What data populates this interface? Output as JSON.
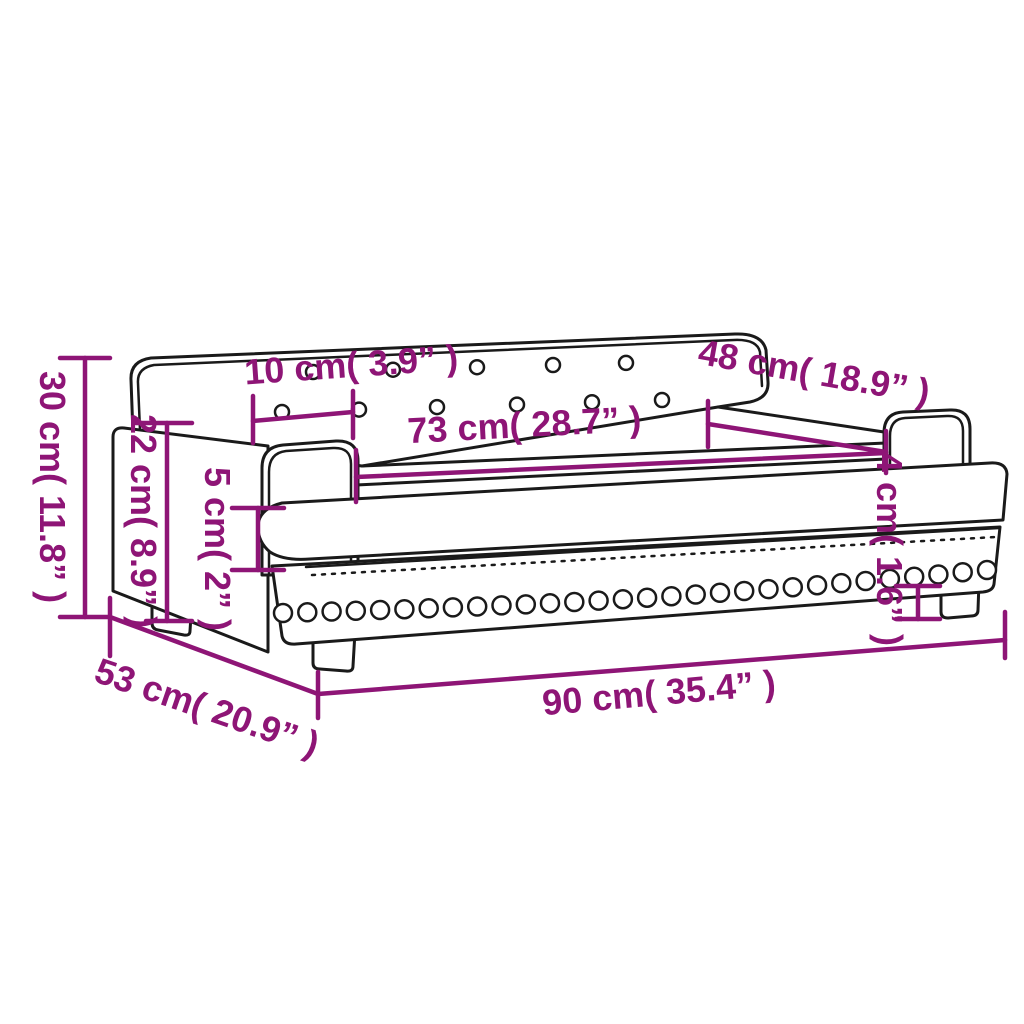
{
  "diagram": {
    "type": "product-dimension-drawing",
    "subject": "kids sofa with tufted backrest, two armrests, studded base band and four legs",
    "background_color": "#ffffff",
    "drawing_line_color": "#1a1a1a",
    "dimension_color": "#8E1576",
    "labels": {
      "total_height": "30 cm( 11.8” )",
      "side_height": "22 cm( 8.9” )",
      "cushion_thickness": "5 cm( 2” )",
      "armrest_width": "10 cm( 3.9” )",
      "seat_width": "73 cm( 28.7” )",
      "seat_depth": "48 cm( 18.9” )",
      "leg_height": "4 cm( 1.6” )",
      "total_depth": "53 cm( 20.9” )",
      "total_width": "90 cm( 35.4” )"
    },
    "tufting": {
      "row1_count": 5,
      "row2_count": 6
    },
    "studs": {
      "count": 30
    }
  }
}
